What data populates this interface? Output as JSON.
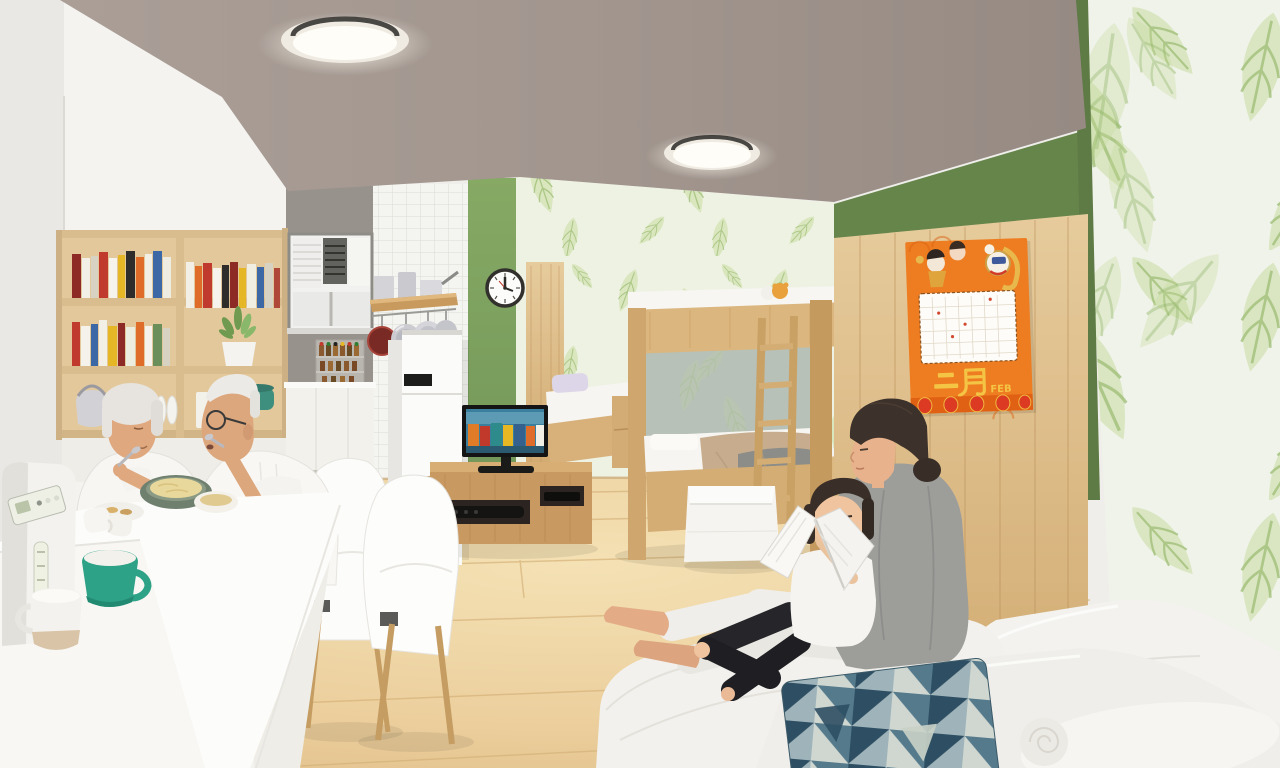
{
  "scene": {
    "title": "3D interior rendering of a small open-plan family flat",
    "figures": [
      "grandmother eating at the dining table",
      "grandfather eating with a spoon",
      "mother reading a book with her daughter on a floor sofa"
    ],
    "areas": [
      "dining corner with white table and shell chairs",
      "compact kitchen with fridge, window air-conditioner and hanging pans",
      "tv corner with wooden media console",
      "single bed and wooden bunk bed with ladder",
      "lounge corner with white sofa and geometric pillow"
    ]
  },
  "calendar": {
    "month_zh": "二月",
    "month_en": "FEB",
    "style": "chinese new year lion-dance poster"
  },
  "palette": {
    "ceiling": "#a2968f",
    "accent_green": "#7ea15e",
    "accent_green_dark": "#66854b",
    "leaf_wall_bg": "#eef2e3",
    "leaf_green": "#b9d494",
    "wood_light": "#e3c89c",
    "wood_mid": "#cfa76e",
    "floor_wood": "#ecd2a2",
    "tile_white": "#f4f4f0",
    "mug_teal": "#2ea287",
    "calendar_orange": "#ee7c20",
    "pillow_navy": "#2e4f63"
  }
}
